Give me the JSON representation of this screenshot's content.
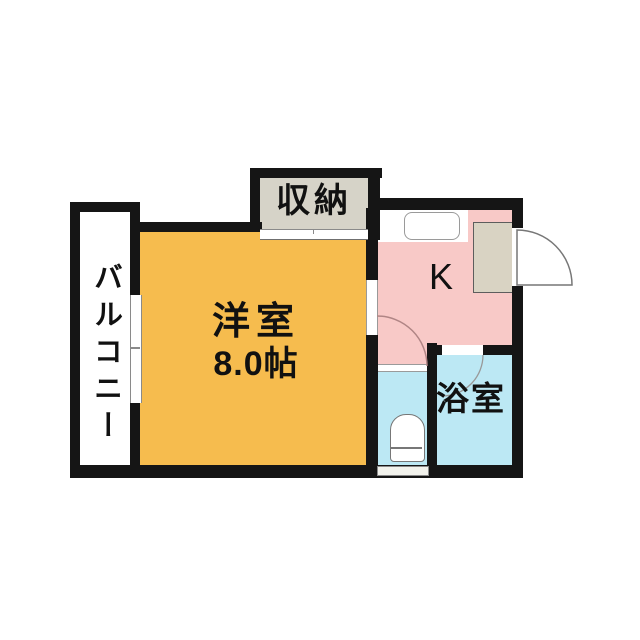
{
  "floorplan": {
    "title": "1K apartment floor plan",
    "rooms": {
      "balcony": {
        "label": "バルコニー"
      },
      "closet": {
        "label": "収納"
      },
      "western_room": {
        "label": "洋室",
        "size": "8.0帖"
      },
      "kitchen": {
        "label": "K"
      },
      "bathroom": {
        "label": "浴室"
      }
    },
    "fixtures": [
      "kitchen-sink",
      "entrance-cabinet",
      "entrance-door-swing",
      "room-door-swing",
      "bathroom-door-swing",
      "toilet",
      "balcony-window",
      "closet-sliding-door"
    ],
    "colors": {
      "wall": "#151515",
      "western_room": "#F6BC4E",
      "kitchen": "#F8C9C7",
      "water_area": "#BCE8F4",
      "closet": "#D6D3C8",
      "cabinet": "#D9D3C3",
      "background": "#FFFFFF"
    }
  }
}
